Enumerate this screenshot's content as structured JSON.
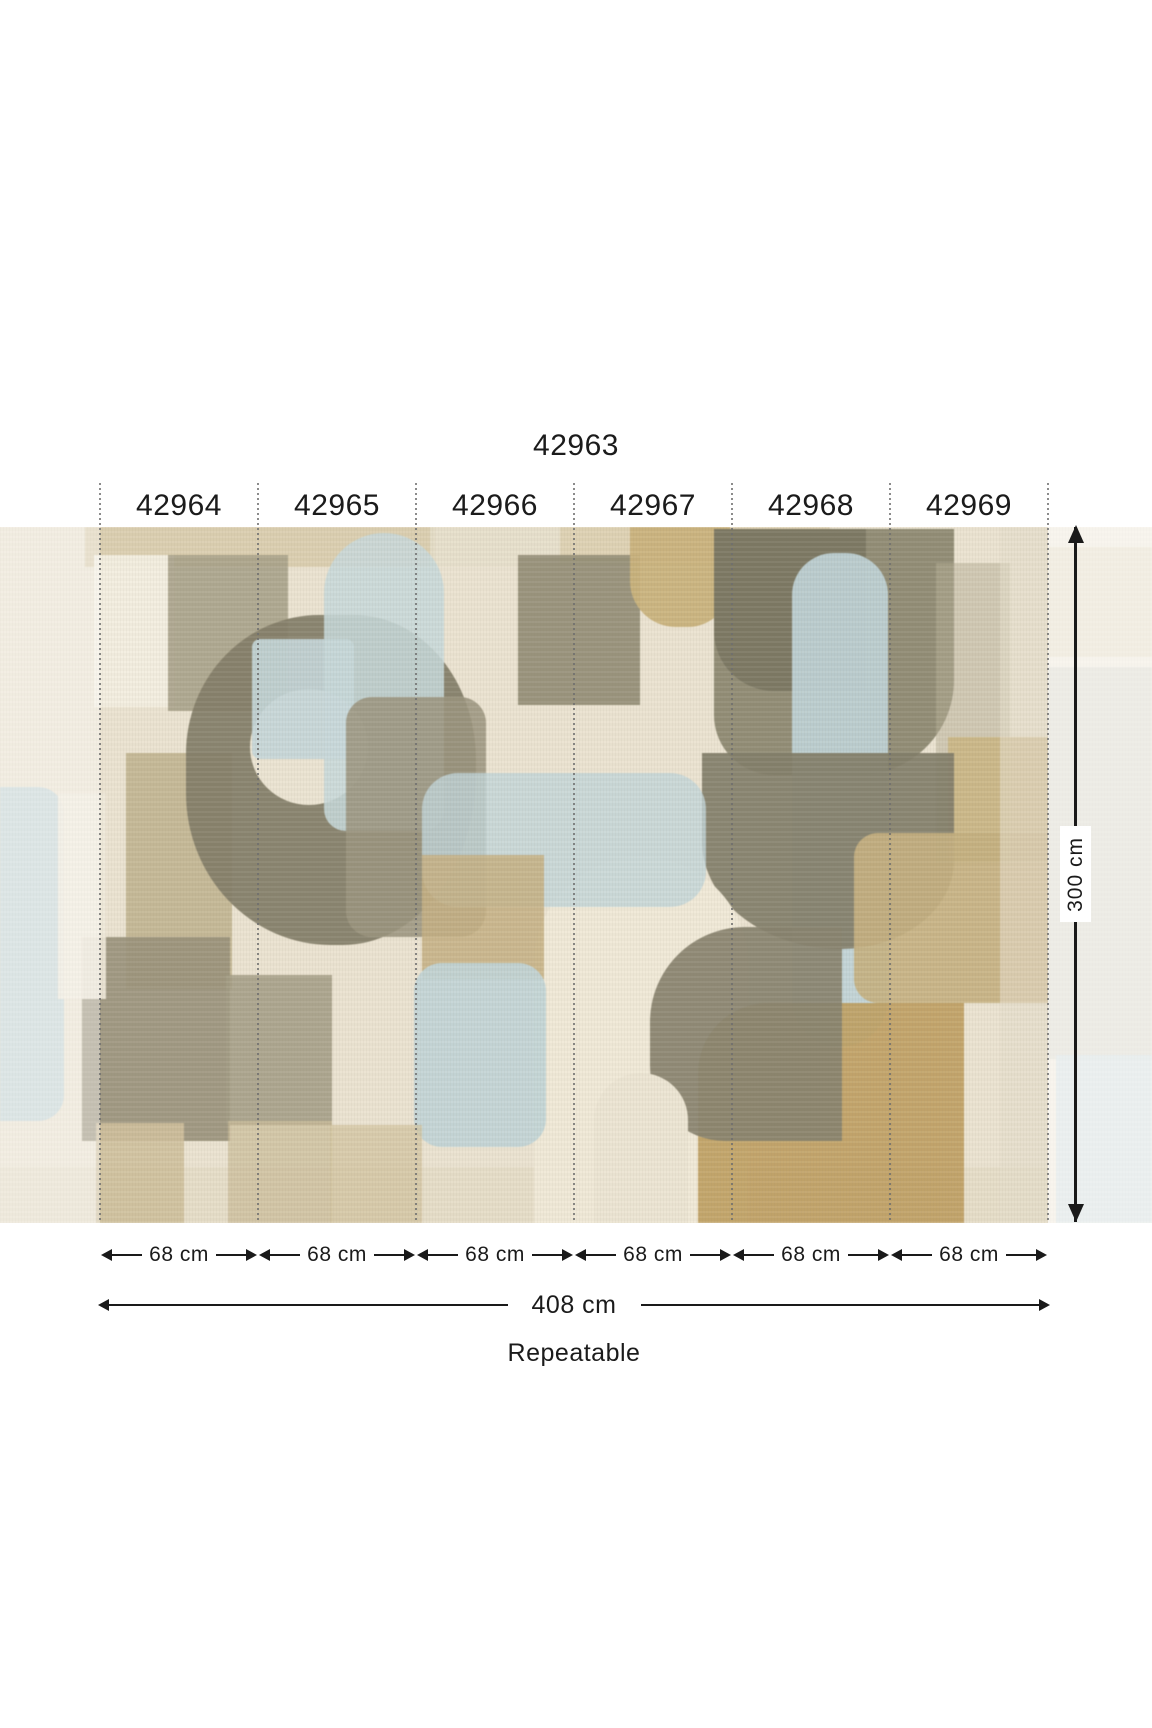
{
  "diagram": {
    "title": "42963",
    "panels": {
      "labels": [
        "42964",
        "42965",
        "42966",
        "42967",
        "42968",
        "42969"
      ],
      "width_labels": [
        "68 cm",
        "68 cm",
        "68 cm",
        "68 cm",
        "68 cm",
        "68 cm"
      ]
    },
    "dimensions": {
      "height": "300 cm",
      "total_width": "408 cm",
      "repeat_note": "Repeatable"
    },
    "icons": {
      "horizontal_dimension": "double-arrow-horizontal",
      "vertical_dimension": "double-arrow-vertical",
      "panel_divider": "dotted-vertical-line"
    },
    "colors": {
      "text": "#1b1b1b",
      "mural_cream": "#ebe3d1",
      "mural_tan": "#c7b284",
      "mural_ochre": "#bf9f63",
      "mural_olive": "#8b8671",
      "mural_dark_olive": "#7a7562",
      "mural_gray_green": "#a49d85",
      "mural_pale_blue": "#c2d4d7"
    }
  }
}
